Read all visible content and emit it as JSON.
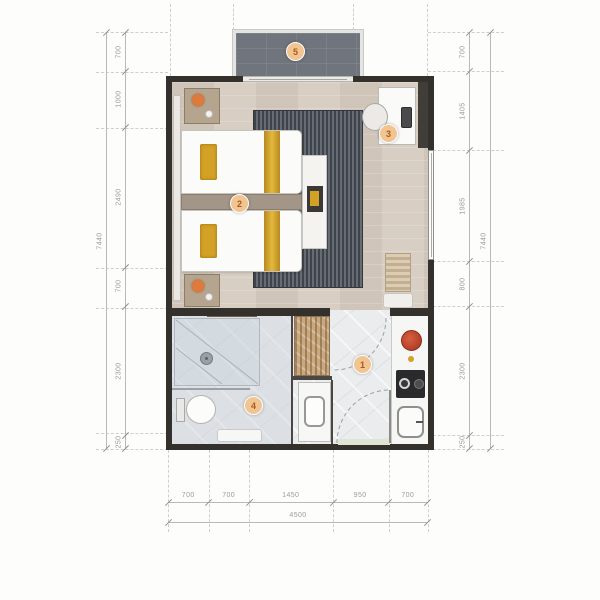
{
  "plan_markers": [
    "1",
    "2",
    "3",
    "4",
    "5"
  ],
  "dimensions": {
    "left": {
      "segments": [
        "700",
        "1000",
        "2490",
        "700",
        "2300",
        "250"
      ],
      "total": "7440"
    },
    "right": {
      "segments": [
        "700",
        "1405",
        "1985",
        "800",
        "2300",
        "250"
      ],
      "total": "7440"
    },
    "bottom": {
      "segments": [
        "700",
        "700",
        "1450",
        "950",
        "700"
      ],
      "total": "4500"
    }
  },
  "colors": {
    "wall": "#34312d",
    "wood_floor": "#d6ccc0",
    "rug": "#50545c",
    "marble": "#eaecee",
    "balcony": "#70747c",
    "gold_accent": "#d2a125",
    "marker_bg": "#f2c492",
    "marker_text": "#a85c17",
    "dim_text": "#9b9b9b"
  }
}
